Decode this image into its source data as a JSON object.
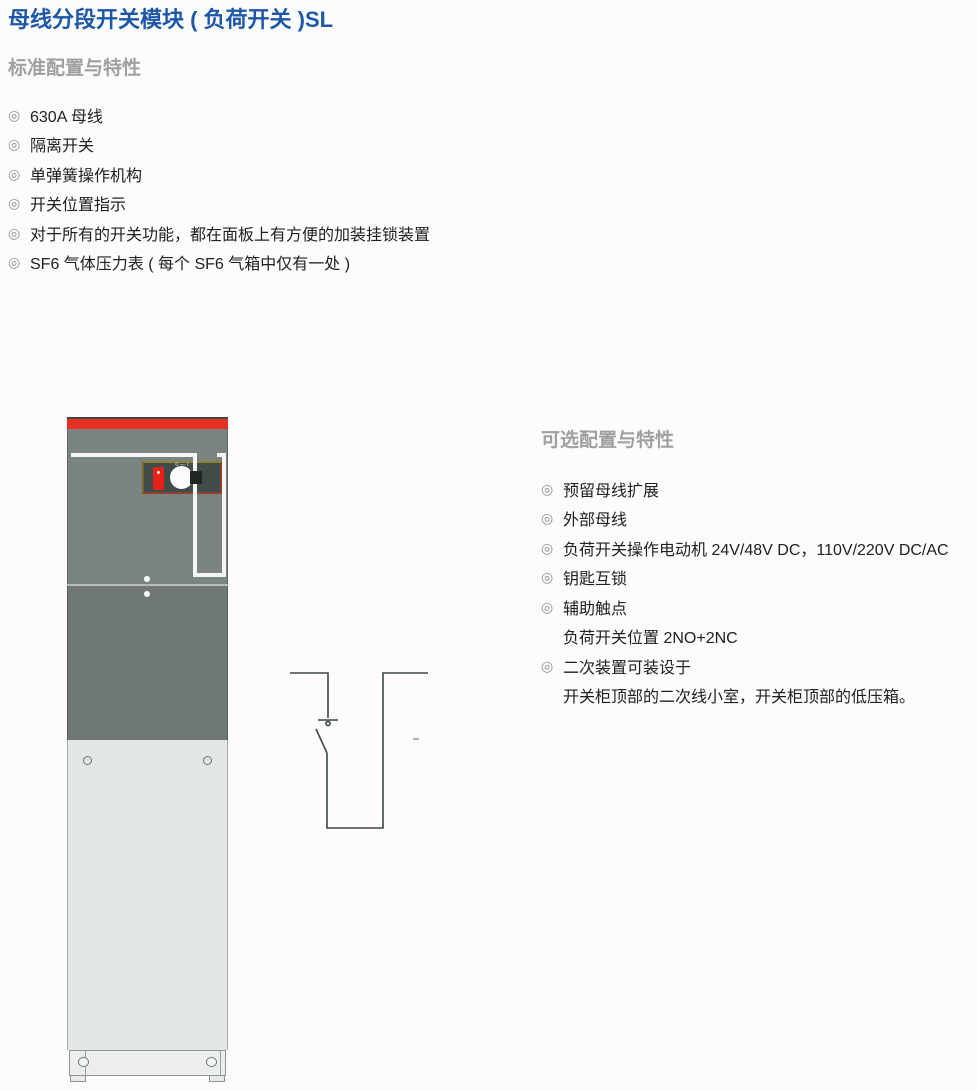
{
  "page": {
    "title": "母线分段开关模块 ( 负荷开关 )SL"
  },
  "standard": {
    "heading": "标准配置与特性",
    "items": [
      "630A 母线",
      "隔离开关",
      "单弹簧操作机构",
      "开关位置指示",
      "对于所有的开关功能，都在面板上有方便的加装挂锁装置",
      "SF6 气体压力表 ( 每个 SF6 气箱中仅有一处 )"
    ]
  },
  "optional": {
    "heading": "可选配置与特性",
    "items": [
      "预留母线扩展",
      "外部母线",
      "负荷开关操作电动机 24V/48V DC，110V/220V DC/AC",
      "钥匙互锁",
      "辅助触点",
      "负荷开关位置 2NO+2NC",
      "二次装置可装设于",
      "开关柜顶部的二次线小室，开关柜顶部的低压箱。"
    ]
  },
  "glyphs": {
    "bullet": "◎"
  },
  "figure": {
    "cabinet": {
      "knob_markings": "0—I",
      "colors": {
        "top_strip": "#e63122",
        "upper_panel": "#7c8481",
        "mid_panel": "#6f7875",
        "lower_panel": "#e3e7e7",
        "mimic_line": "#f4f6f5",
        "control_panel": "#414c4a",
        "indicator_red": "#e6211a"
      }
    },
    "diagram": {
      "line_color": "#3d4745",
      "dash_color": "#9aa09e"
    }
  },
  "text_colors": {
    "title": "#1d57a8",
    "heading": "#a0a0a0",
    "body": "#202020",
    "bullet": "#8f8f8f"
  }
}
